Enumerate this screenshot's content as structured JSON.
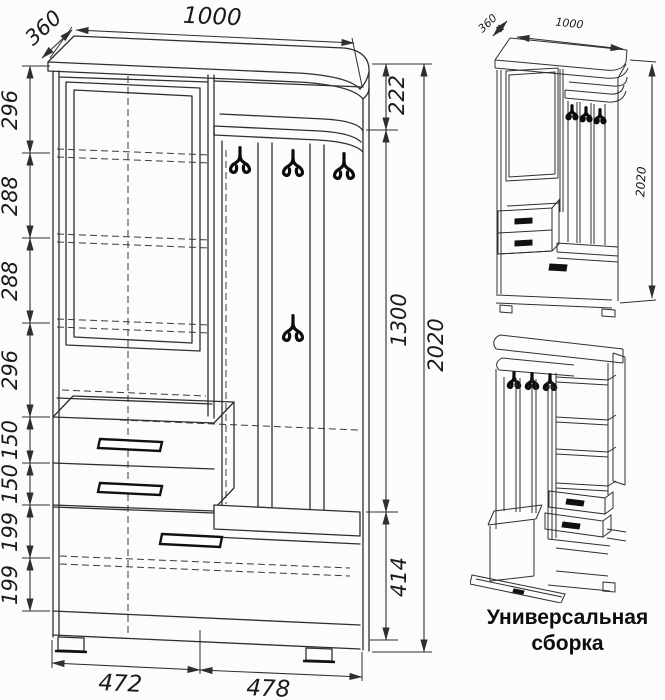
{
  "colors": {
    "line_color": "#2f2f2f",
    "background": "#fcfcfc",
    "ink": "#0d0d0d"
  },
  "front_view": {
    "width_top": "1000",
    "depth_top": "360",
    "left_dims": [
      "296",
      "288",
      "288",
      "296",
      "150",
      "150",
      "199",
      "199"
    ],
    "right_dims": [
      "222",
      "1300",
      "414"
    ],
    "overall_height": "2020",
    "bottom_dims": [
      "472",
      "478"
    ]
  },
  "assembly": {
    "depth": "360",
    "width": "1000",
    "height": "2020",
    "caption": "Универсальная сборка"
  }
}
